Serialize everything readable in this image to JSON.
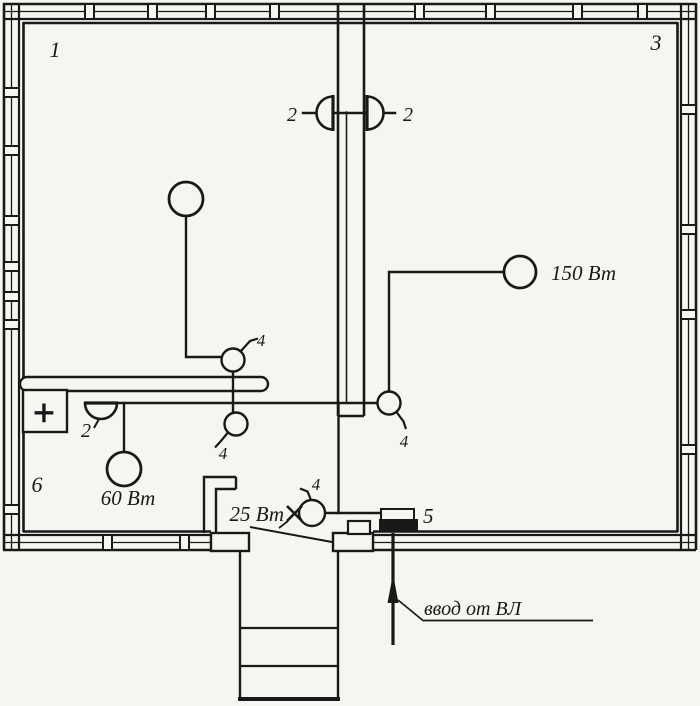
{
  "palette": {
    "background": "#f5f5f1",
    "ink": "#191919"
  },
  "room_labels": {
    "top_left": "1",
    "right": "3",
    "bottom_left": "6"
  },
  "wall_lamp_labels": {
    "hall_left": "2",
    "hall_right": "2",
    "kitchen": "2"
  },
  "switch_labels": {
    "room1": "4",
    "kitchen": "4",
    "room3": "4",
    "entry": "4"
  },
  "lamp_power_labels": {
    "room3": "150 Вт",
    "kitchen": "60 Вт",
    "entry": "25 Вт"
  },
  "meter": {
    "label": "5"
  },
  "stove_box": {
    "symbol": "+"
  },
  "service_entry": {
    "note": "ввод от ВЛ"
  }
}
